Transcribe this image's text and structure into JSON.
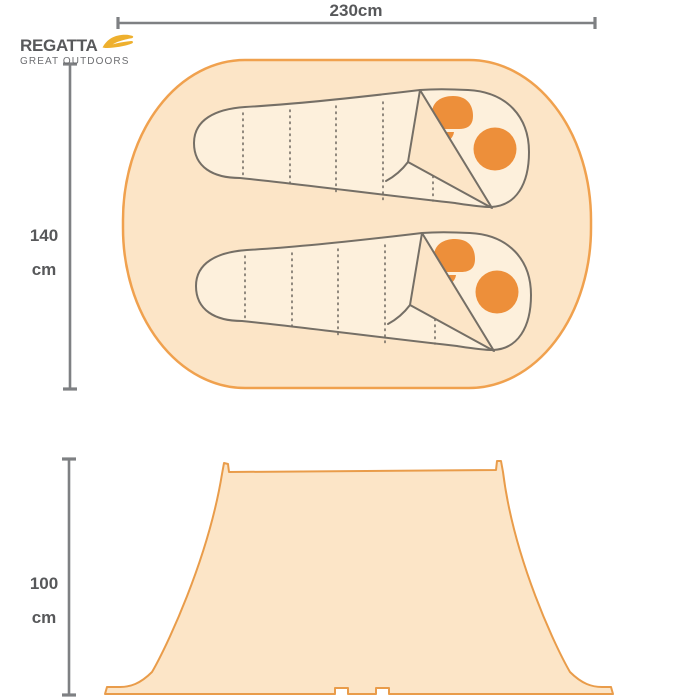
{
  "brand": {
    "name": "REGATTA",
    "tagline": "GREAT OUTDOORS",
    "swoosh_icon": "regatta-swoosh-icon"
  },
  "dimensions": {
    "width": {
      "label": "230cm"
    },
    "depth": {
      "value": "140",
      "unit": "cm"
    },
    "height": {
      "value": "100",
      "unit": "cm"
    }
  },
  "views": {
    "top": {
      "sleeping_bag_count": 2
    },
    "side": {}
  },
  "colors": {
    "background": "#ffffff",
    "canvas_fill": "#fce5c7",
    "bag_fill": "#fdf0dc",
    "oval_outline": "#f0a14e",
    "tent_outline": "#e99c4a",
    "accent_orange": "#ed8f3a",
    "bag_outline_gray": "#756f66",
    "dimension_line_gray": "#7e8083",
    "label_text": "#57585a",
    "brand_text": "#58595b",
    "brand_swoosh": "#eeb02e"
  }
}
